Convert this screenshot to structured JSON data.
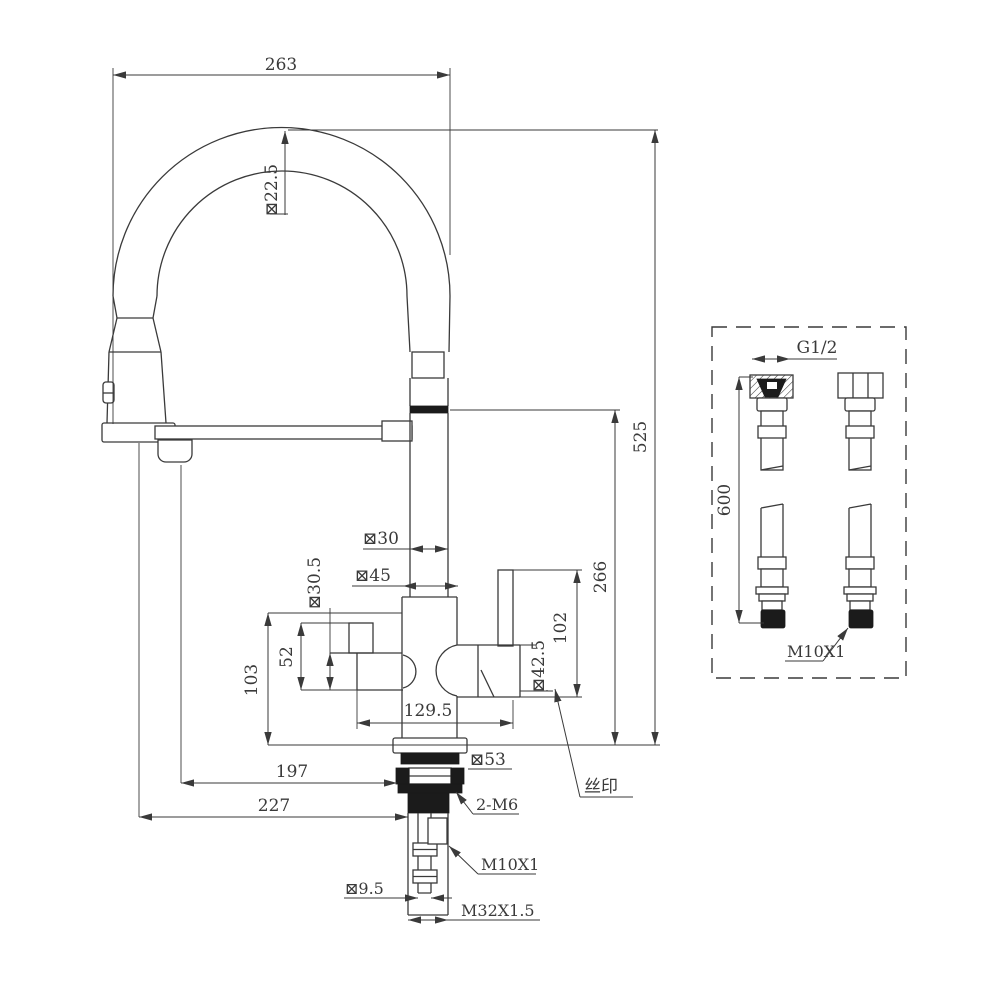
{
  "drawing": {
    "kind": "technical dimension drawing",
    "product": "pull-down spring kitchen faucet with supply hoses",
    "line_color": "#3a3a3a",
    "background": "#ffffff"
  },
  "dimensions": {
    "overall_width": "263",
    "hose_tube_dia": "⊠22.5",
    "overall_height": "525",
    "spout_height": "266",
    "riser_dia": "⊠30",
    "body_dia": "⊠45",
    "outlet_dia": "⊠30.5",
    "outlet_section_height": "52",
    "body_section_height": "103",
    "handle_section_height": "102",
    "cartridge_dia": "⊠42.5",
    "spout_reach": "129.5",
    "nozzle_reach": "197",
    "overall_reach": "227",
    "base_dia": "⊠53",
    "set_screws": "2-M6",
    "inlet_fitting_thread": "M10X1",
    "inlet_pipe_dia": "⊠9.5",
    "shank_thread": "M32X1.5",
    "silkscreen_note": "丝印"
  },
  "accessory_panel": {
    "hose_length": "600",
    "hose_nut_thread": "G1/2",
    "hose_tip_thread": "M10X1"
  }
}
